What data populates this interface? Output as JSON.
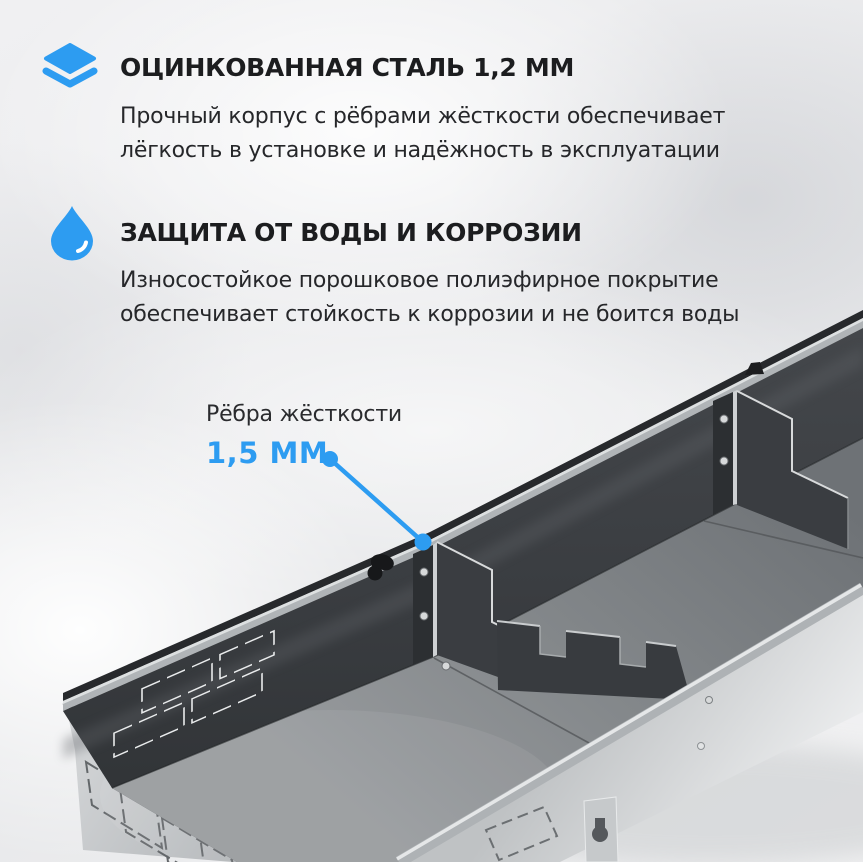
{
  "colors": {
    "accent": "#2D9CF1",
    "heading_text": "#1C1D1F",
    "body_text": "#26272A"
  },
  "features": [
    {
      "icon": "layers-icon",
      "title": "ОЦИНКОВАННАЯ СТАЛЬ 1,2 ММ",
      "lines": [
        "Прочный корпус с рёбрами жёсткости обеспечивает",
        "лёгкость в установке и надёжность в эксплуатации"
      ]
    },
    {
      "icon": "water-drop-icon",
      "title": "ЗАЩИТА ОТ ВОДЫ И КОРРОЗИИ",
      "lines": [
        "Износостойкое порошковое полиэфирное покрытие",
        "обеспечивает стойкость к коррозии и не боится воды"
      ]
    }
  ],
  "callout": {
    "label": "Рёбра жёсткости",
    "value": "1,5 ММ"
  }
}
